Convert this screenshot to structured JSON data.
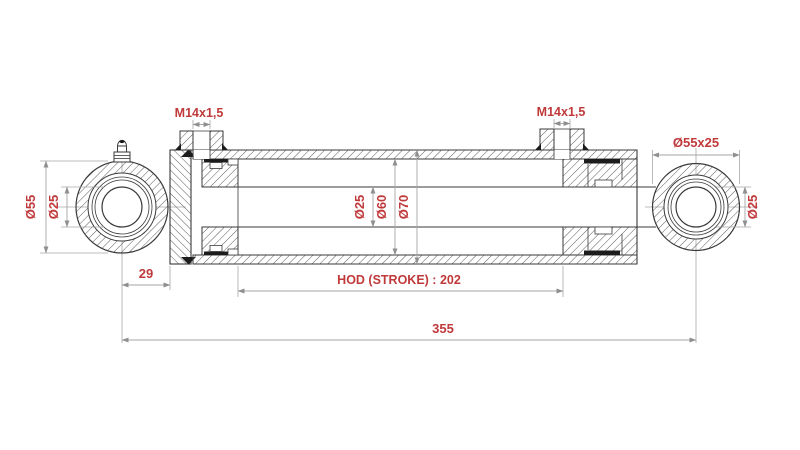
{
  "drawing": {
    "type": "technical-drawing",
    "subject": "double-acting hydraulic cylinder cross-section with dimensions",
    "colors": {
      "background": "#ffffff",
      "outline": "#3a3a3a",
      "dimension_line": "#a6a6a6",
      "dimension_text": "#c0393b"
    },
    "labels": {
      "port_left_thread": "M14x1,5",
      "port_right_thread": "M14x1,5",
      "right_eye_size": "Ø55x25",
      "left_eye_outer_dia": "Ø55",
      "left_eye_bore_dia": "Ø25",
      "rod_dia": "Ø25",
      "bore_dia": "Ø60",
      "barrel_outer_dia": "Ø70",
      "right_eye_bore_dia": "Ø25",
      "eye_center_to_head": "29",
      "stroke_length": "HOD (STROKE) : 202",
      "overall_length": "355"
    }
  }
}
